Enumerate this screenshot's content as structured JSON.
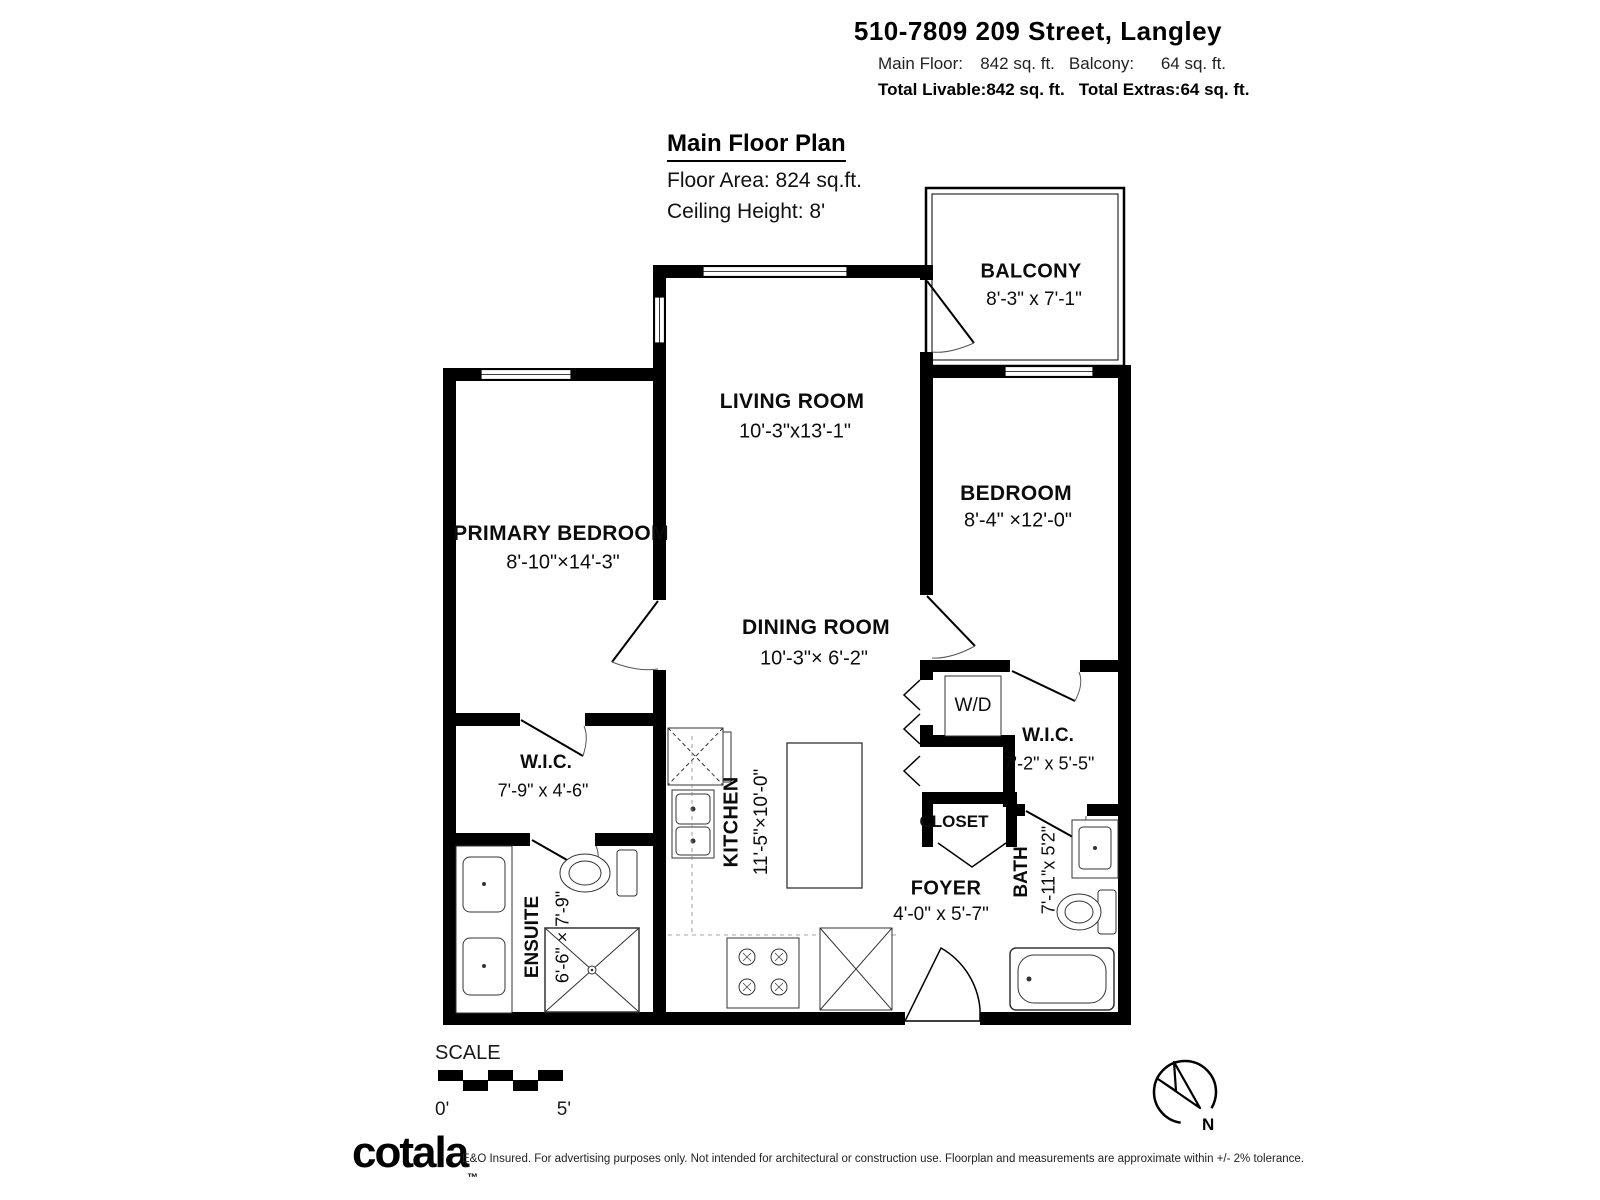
{
  "header": {
    "title": "510-7809 209 Street, Langley",
    "main_floor_label": "Main Floor:",
    "main_floor_value": "842 sq. ft.",
    "balcony_label": "Balcony:",
    "balcony_value": "64 sq. ft.",
    "total_livable_label": "Total Livable:",
    "total_livable_value": "842 sq. ft.",
    "total_extras_label": "Total Extras:",
    "total_extras_value": "64 sq. ft."
  },
  "plan_info": {
    "title": "Main Floor Plan",
    "floor_area": "Floor Area: 824 sq.ft.",
    "ceiling_height": "Ceiling Height: 8'"
  },
  "rooms": {
    "balcony": {
      "name": "BALCONY",
      "dims": "8'-3\" x 7'-1\""
    },
    "living": {
      "name": "LIVING ROOM",
      "dims": "10'-3\"x13'-1\""
    },
    "bedroom": {
      "name": "BEDROOM",
      "dims": "8'-4\" ×12'-0\""
    },
    "primary": {
      "name": "PRIMARY BEDROOM",
      "dims": "8'-10\"×14'-3\""
    },
    "dining": {
      "name": "DINING ROOM",
      "dims": "10'-3\"× 6'-2\""
    },
    "wic_right": {
      "name": "W.I.C.",
      "dims": "7'-2\" x 5'-5\""
    },
    "wic_left": {
      "name": "W.I.C.",
      "dims": "7'-9\" x 4'-6\""
    },
    "kitchen": {
      "name": "KITCHEN",
      "dims": "11'-5\"×10'-0\""
    },
    "closet": {
      "name": "CLOSET"
    },
    "foyer": {
      "name": "FOYER",
      "dims": "4'-0\" x 5'-7\""
    },
    "bath": {
      "name": "BATH",
      "dims": "7'-11\"x 5'2\""
    },
    "ensuite": {
      "name": "ENSUITE",
      "dims": "6'-6\" × 7'-9\""
    },
    "washer_dryer": {
      "name": "W/D"
    }
  },
  "scale_bar": {
    "label": "SCALE",
    "start": "0'",
    "end": "5'"
  },
  "compass": {
    "label": "N"
  },
  "footer": {
    "logo": "cotala",
    "trademark": "™",
    "disclaimer": "E&O Insured. For advertising purposes only. Not intended for architectural or construction use. Floorplan and measurements are approximate within +/- 2% tolerance."
  },
  "colors": {
    "wall": "#000000",
    "background": "#ffffff",
    "fixture_line": "#333333"
  }
}
